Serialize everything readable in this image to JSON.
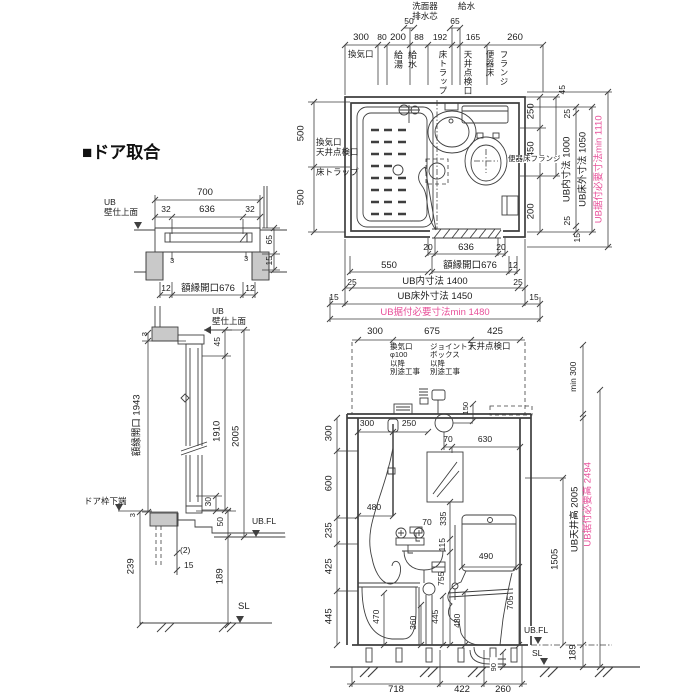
{
  "title": "■ドア取合",
  "colors": {
    "pink": "#e8509a",
    "line": "#3f3f3f"
  },
  "plan": {
    "upper": {
      "washer_drain": "洗面器\n排水芯",
      "supply": "給水",
      "d50": "50",
      "d65": "65"
    },
    "top_dims": [
      "300",
      "80",
      "200",
      "88",
      "192",
      "165",
      "260"
    ],
    "top_cols": [
      "換気口",
      "給湯",
      "給水",
      "床トラップ",
      "天井点検口",
      "便器床",
      "フランジ"
    ],
    "left": {
      "d500a": "500",
      "d500b": "500",
      "vent": "換気口\n天井点検口",
      "trap": "床トラップ"
    },
    "right": {
      "d45": "45",
      "d250": "250",
      "d450": "450",
      "flange": "便器床フランジ",
      "d200": "200",
      "d25a": "25",
      "inner": "UB内寸法 1000",
      "d25b": "25",
      "outer": "UB床外寸法 1050",
      "req": "UB据付必要寸法min 1110",
      "d15": "15"
    },
    "bottom": {
      "d20a": "20",
      "d636": "636",
      "d20b": "20",
      "d550": "550",
      "gaku": "額縁開口676",
      "d12": "12",
      "d25a": "25",
      "inner": "UB内寸法 1400",
      "d25b": "25",
      "d15a": "15",
      "outer": "UB床外寸法 1450",
      "d15b": "15",
      "req": "UB据付必要寸法min 1480"
    }
  },
  "door_h": {
    "d700": "700",
    "datum": "UB\n壁仕上面",
    "d32a": "32",
    "d636": "636",
    "d32b": "32",
    "d3a": "3",
    "d3b": "3",
    "d65": "65",
    "d15": "15",
    "d12a": "12",
    "gaku": "額縁開口676",
    "d12b": "12"
  },
  "door_v": {
    "datum": "UB\n壁仕上面",
    "d3top": "3",
    "gaku": "額縁開口 1943",
    "d45": "45",
    "d1910": "1910",
    "d2005": "2005",
    "shita": "ドア枠下端",
    "d3b": "3",
    "d30": "30",
    "d50": "50",
    "ubfl": "UB.FL",
    "d2": "(2)",
    "d15": "15",
    "d239": "239",
    "d189": "189",
    "sl": "SL"
  },
  "elev": {
    "top_dims": [
      "300",
      "675",
      "425"
    ],
    "vent": "換気口\nφ100\n以降\n別途工事",
    "joint": "ジョイント\nボックス\n以降\n別途工事",
    "tenken": "天井点検口",
    "min300": "min 300",
    "in300": "300",
    "in250": "250",
    "d150": "150",
    "d70a": "70",
    "d630": "630",
    "d480a": "480",
    "d70b": "70",
    "d335": "335",
    "d115": "115",
    "d755": "755",
    "d490": "490",
    "d705": "705",
    "d445": "445",
    "d480b": "480",
    "d360": "360",
    "d470": "470",
    "left_dims": [
      "300",
      "600",
      "235",
      "425",
      "445"
    ],
    "r1505": "1505",
    "ceil": "UB天井高 2005",
    "req": "UB据付必要高 2494",
    "d189": "189",
    "ubfl": "UB.FL",
    "sl": "SL",
    "d90": "90",
    "bottom_dims": [
      "718",
      "422",
      "260"
    ]
  }
}
